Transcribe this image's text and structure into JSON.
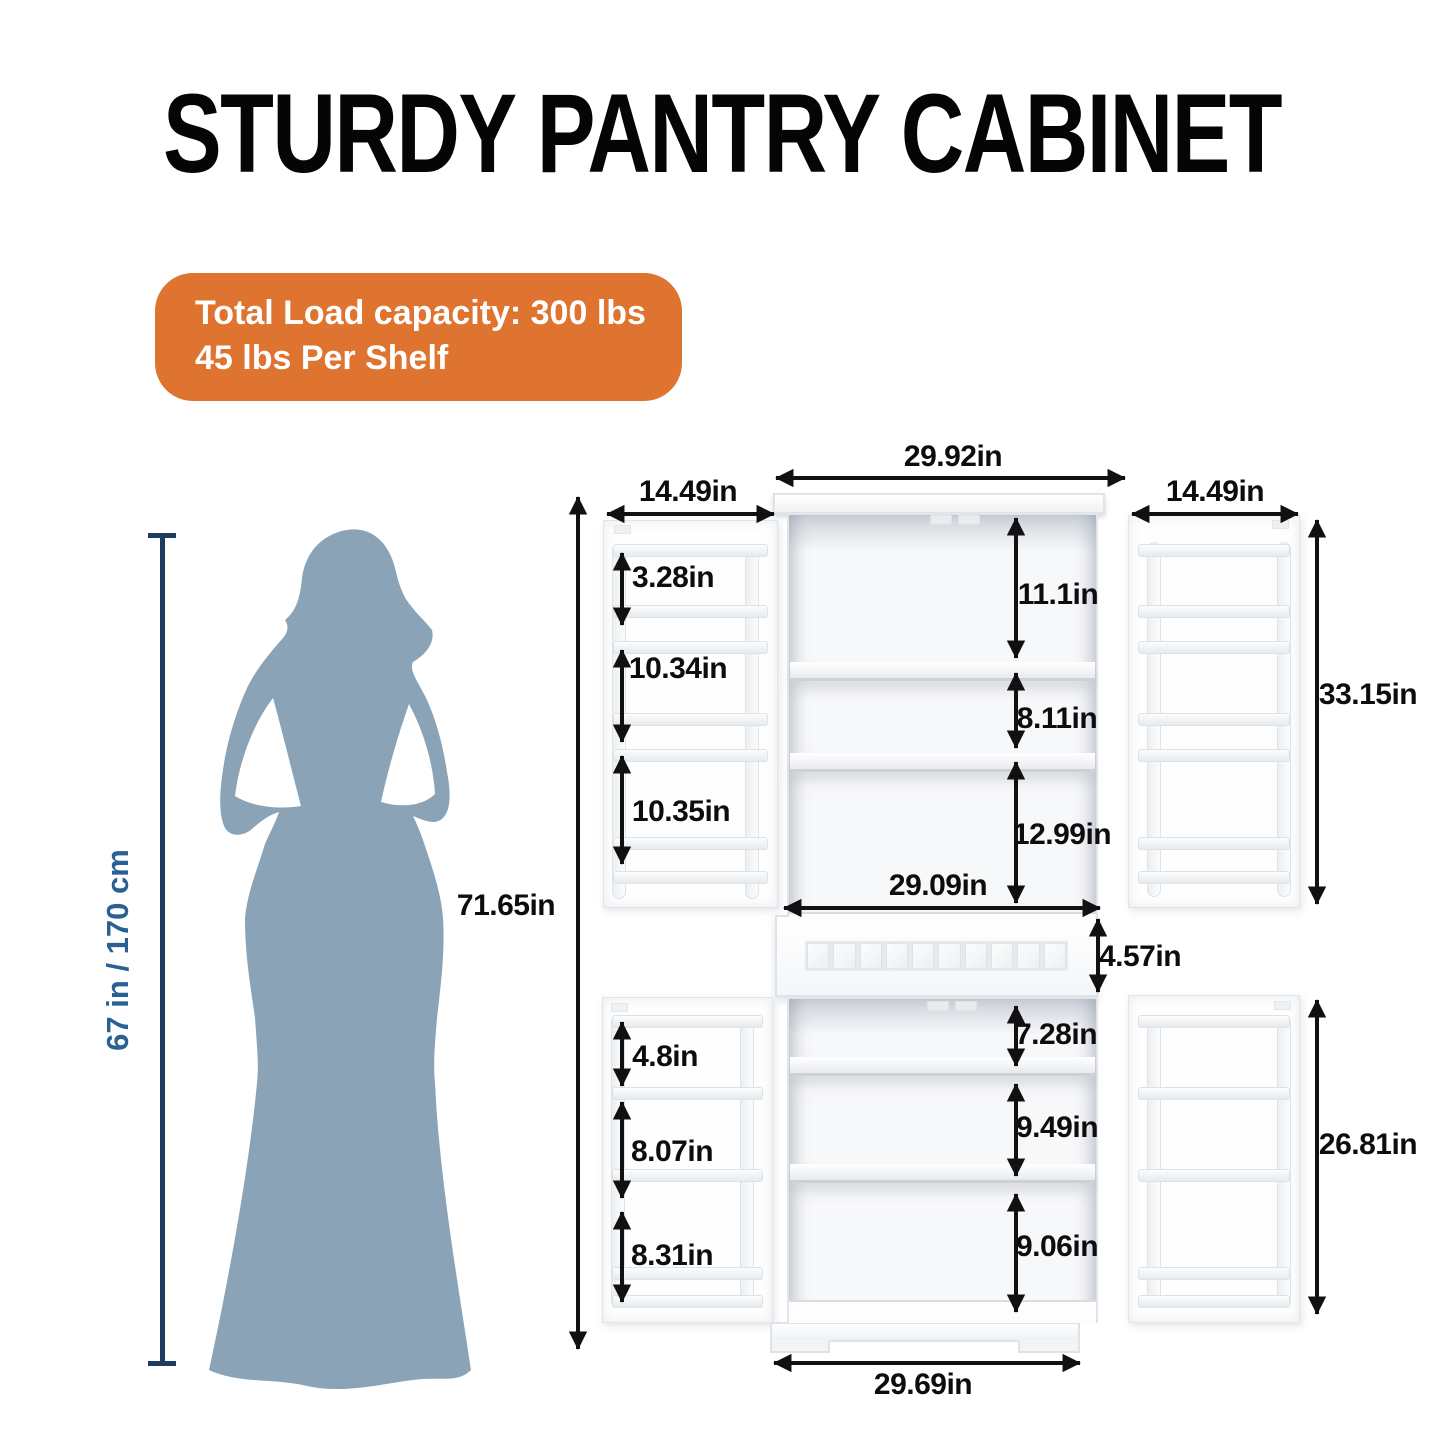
{
  "title": "STURDY PANTRY CABINET",
  "badge": {
    "line1": "Total Load capacity: 300 lbs",
    "line2": "45 lbs Per Shelf",
    "bg_color": "#DE7430",
    "text_color": "#FFFFFF"
  },
  "person": {
    "height_label": "67 in / 170 cm",
    "silhouette_color": "#8BA3B6",
    "line_color": "#1C3E5E",
    "label_color": "#2A6195"
  },
  "dims": {
    "overall_height": "71.65in",
    "top_width": "29.92in",
    "left_door_width": "14.49in",
    "right_door_width": "14.49in",
    "upper_right_door_height": "33.15in",
    "upper_left_door": [
      "3.28in",
      "10.34in",
      "10.35in"
    ],
    "upper_interior": [
      "11.1in",
      "8.11in",
      "12.99in"
    ],
    "interior_width": "29.09in",
    "drawer_height": "4.57in",
    "lower_interior": [
      "7.28in",
      "9.49in",
      "9.06in"
    ],
    "lower_left_door": [
      "4.8in",
      "8.07in",
      "8.31in"
    ],
    "lower_right_door_height": "26.81in",
    "bottom_width": "29.69in"
  },
  "arrow_color": "#111111"
}
